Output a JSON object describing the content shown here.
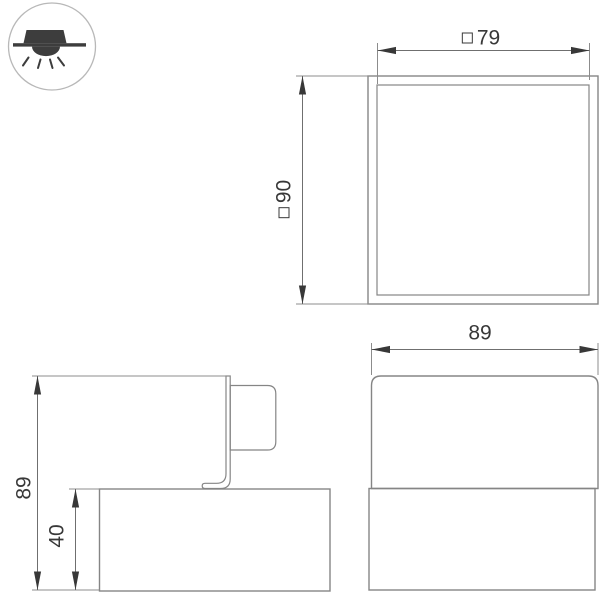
{
  "page": {
    "background": "#ffffff",
    "width": 600,
    "height": 592,
    "type": "technical-dimension-drawing"
  },
  "colors": {
    "shape_line": "#858585",
    "dimension_line": "#6f6f6f",
    "arrow_and_text": "#383838",
    "icon_fill": "#3d3d3d",
    "badge_circle_outline": "#b8b8b8"
  },
  "badge": {
    "icon": "ceiling-surface-mounted-light-icon"
  },
  "dimensions": {
    "top_width": {
      "symbol": "□",
      "value": "79"
    },
    "top_size": {
      "symbol": "□",
      "value": "90"
    },
    "side_height": {
      "value": "89"
    },
    "side_body_height": {
      "value": "40"
    },
    "front_width": {
      "value": "89"
    }
  }
}
